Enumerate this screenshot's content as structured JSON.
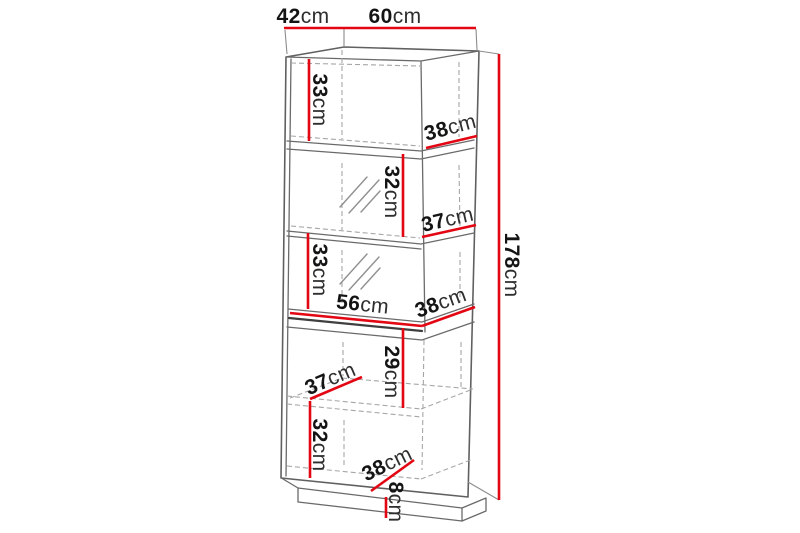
{
  "figure": {
    "type": "furniture-dimension-diagram",
    "subject": "tall-display-cabinet-with-plinth",
    "unit": "cm",
    "colors": {
      "dimension_line": "#e30613",
      "outline": "#6a6a6a",
      "hidden_edge": "#a6a6a6",
      "label_text": "#141414",
      "background": "#ffffff"
    },
    "dims": {
      "top_depth": {
        "v": "42",
        "u": "cm"
      },
      "top_width": {
        "v": "60",
        "u": "cm"
      },
      "total_height": {
        "v": "178",
        "u": "cm"
      },
      "top_compartment_height": {
        "v": "33",
        "u": "cm"
      },
      "top_compartment_depth": {
        "v": "38",
        "u": "cm"
      },
      "upper_display_height": {
        "v": "32",
        "u": "cm"
      },
      "upper_display_depth": {
        "v": "37",
        "u": "cm"
      },
      "lower_display_height": {
        "v": "33",
        "u": "cm"
      },
      "interior_width": {
        "v": "56",
        "u": "cm"
      },
      "counter_depth": {
        "v": "38",
        "u": "cm"
      },
      "niche_depth": {
        "v": "37",
        "u": "cm"
      },
      "niche_height": {
        "v": "29",
        "u": "cm"
      },
      "lower_cabinet_height": {
        "v": "32",
        "u": "cm"
      },
      "bottom_depth": {
        "v": "38",
        "u": "cm"
      },
      "plinth_height": {
        "v": "8",
        "u": "cm"
      }
    }
  }
}
